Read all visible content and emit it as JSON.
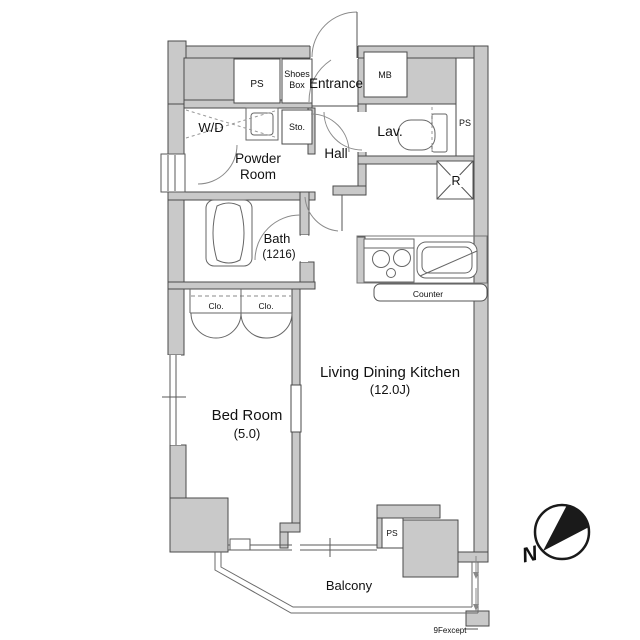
{
  "plan": {
    "labels": {
      "ps_top": "PS",
      "shoes_line1": "Shoes",
      "shoes_line2": "Box",
      "entrance": "Entrance",
      "mb": "MB",
      "wd": "W/D",
      "sto": "Sto.",
      "lav": "Lav.",
      "ps_right": "PS",
      "powder_line1": "Powder",
      "powder_line2": "Room",
      "hall": "Hall",
      "bath_line1": "Bath",
      "bath_line2": "(1216)",
      "fridge": "R",
      "closet_left": "Clo.",
      "closet_right": "Clo.",
      "counter": "Counter",
      "ldk_line1": "Living Dining Kitchen",
      "ldk_line2": "(12.0J)",
      "bedroom_line1": "Bed Room",
      "bedroom_line2": "(5.0)",
      "ps_bottom": "PS",
      "balcony": "Balcony"
    },
    "annotations": {
      "floor_note": "9Fexcept",
      "compass_north": "N"
    },
    "colors": {
      "wall_fill": "#c9c9c9",
      "wall_stroke": "#4a4a4a",
      "fixture_line": "#777777",
      "text": "#111111",
      "compass": "#1a1a1a"
    }
  }
}
